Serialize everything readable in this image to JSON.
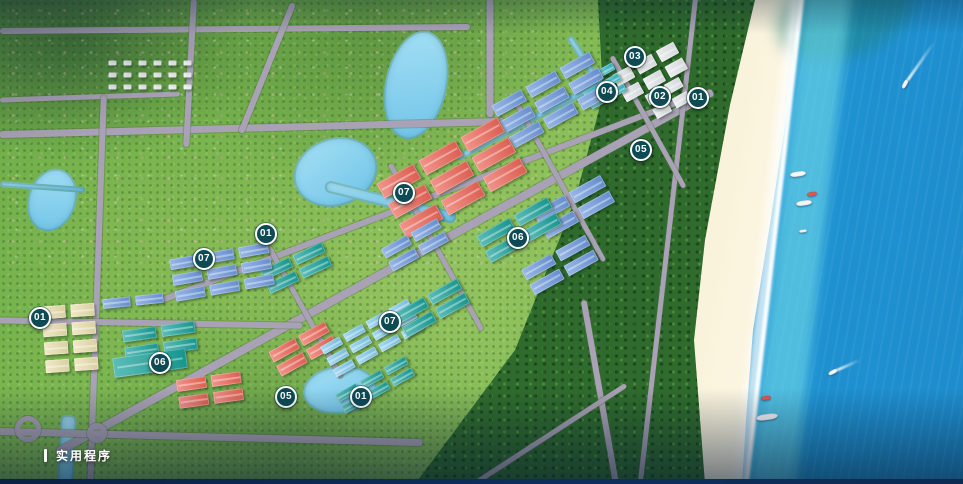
{
  "overlay": {
    "section_label": "实用程序"
  },
  "palette": {
    "marker_bg": "#0d4a54",
    "marker_border": "#ffffff",
    "marker_text": "#ffffff",
    "road": "#a9a1b5",
    "water": "#7ecbed",
    "land_green": "#7fb552",
    "forest_green": "#2f6b2d",
    "sand": "#f0e2ba",
    "sea_shallow": "#49c8e3",
    "sea_deep": "#1e8ccd",
    "foam": "#ffffff",
    "building_blue": "#6d98dc",
    "building_teal": "#18a099",
    "building_red": "#ec6557",
    "building_cream": "#eadfae",
    "building_lightblue": "#7fc9ec",
    "building_white": "#e4e8ea",
    "pool_teal": "#35b8c8",
    "boat_white": "#f4f6f8",
    "boat_red": "#e05a4e"
  },
  "markers": [
    {
      "label": "03",
      "x": 635,
      "y": 57
    },
    {
      "label": "04",
      "x": 607,
      "y": 92
    },
    {
      "label": "02",
      "x": 660,
      "y": 97
    },
    {
      "label": "01",
      "x": 698,
      "y": 98
    },
    {
      "label": "05",
      "x": 641,
      "y": 150
    },
    {
      "label": "07",
      "x": 404,
      "y": 193
    },
    {
      "label": "01",
      "x": 266,
      "y": 234
    },
    {
      "label": "06",
      "x": 518,
      "y": 238
    },
    {
      "label": "07",
      "x": 204,
      "y": 259
    },
    {
      "label": "01",
      "x": 40,
      "y": 318
    },
    {
      "label": "07",
      "x": 390,
      "y": 322
    },
    {
      "label": "06",
      "x": 160,
      "y": 363
    },
    {
      "label": "05",
      "x": 286,
      "y": 397
    },
    {
      "label": "01",
      "x": 361,
      "y": 397
    }
  ],
  "boats": [
    {
      "type": "speedboat",
      "x": 905,
      "y": 84,
      "rot": -62,
      "wake_len": 52,
      "wake_rot": -55
    },
    {
      "type": "yacht",
      "x": 798,
      "y": 174,
      "rot": -8
    },
    {
      "type": "boat-red",
      "x": 812,
      "y": 194,
      "rot": -8
    },
    {
      "type": "yacht",
      "x": 804,
      "y": 203,
      "rot": -8
    },
    {
      "type": "boat-small",
      "x": 803,
      "y": 231,
      "rot": -8
    },
    {
      "type": "speedboat",
      "x": 833,
      "y": 372,
      "rot": -28,
      "wake_len": 30,
      "wake_rot": -24
    },
    {
      "type": "boat-red",
      "x": 766,
      "y": 398,
      "rot": -8
    },
    {
      "type": "ship",
      "x": 767,
      "y": 417,
      "rot": -8
    }
  ]
}
